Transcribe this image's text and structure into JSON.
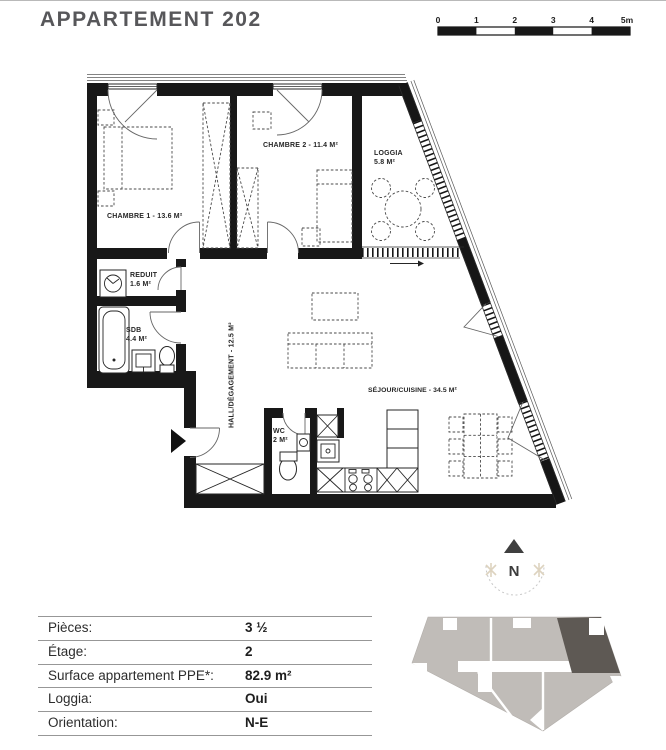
{
  "title": "APPARTEMENT 202",
  "scale_bar": {
    "ticks": [
      "0",
      "1",
      "2",
      "3",
      "4",
      "5m"
    ]
  },
  "plan": {
    "rooms": {
      "chambre1": "CHAMBRE 1 - 13.6 M²",
      "chambre2": "CHAMBRE 2 - 11.4 M²",
      "loggia_name": "LOGGIA",
      "loggia_area": "5.8 M²",
      "reduit_name": "REDUIT",
      "reduit_area": "1.6 M²",
      "sdb_name": "SDB",
      "sdb_area": "4.4 M²",
      "hall": "HALL/DÉGAGEMENT - 12.5 M²",
      "wc_name": "WC",
      "wc_area": "2 M²",
      "sejour": "SÉJOUR/CUISINE - 34.5 M²"
    }
  },
  "compass": {
    "label": "N"
  },
  "details": {
    "rows": [
      {
        "label": "Pièces:",
        "value": "3 ½"
      },
      {
        "label": "Étage:",
        "value": "2"
      },
      {
        "label": "Surface appartement PPE*:",
        "value": "82.9 m²"
      },
      {
        "label": "Loggia:",
        "value": "Oui"
      },
      {
        "label": "Orientation:",
        "value": "N-E"
      }
    ]
  },
  "colors": {
    "wall": "#181818",
    "title_gray": "#57575a",
    "locator_unit": "#c0bcb8",
    "locator_highlight": "#5e5954",
    "compass_accent": "#ddd3bf"
  }
}
